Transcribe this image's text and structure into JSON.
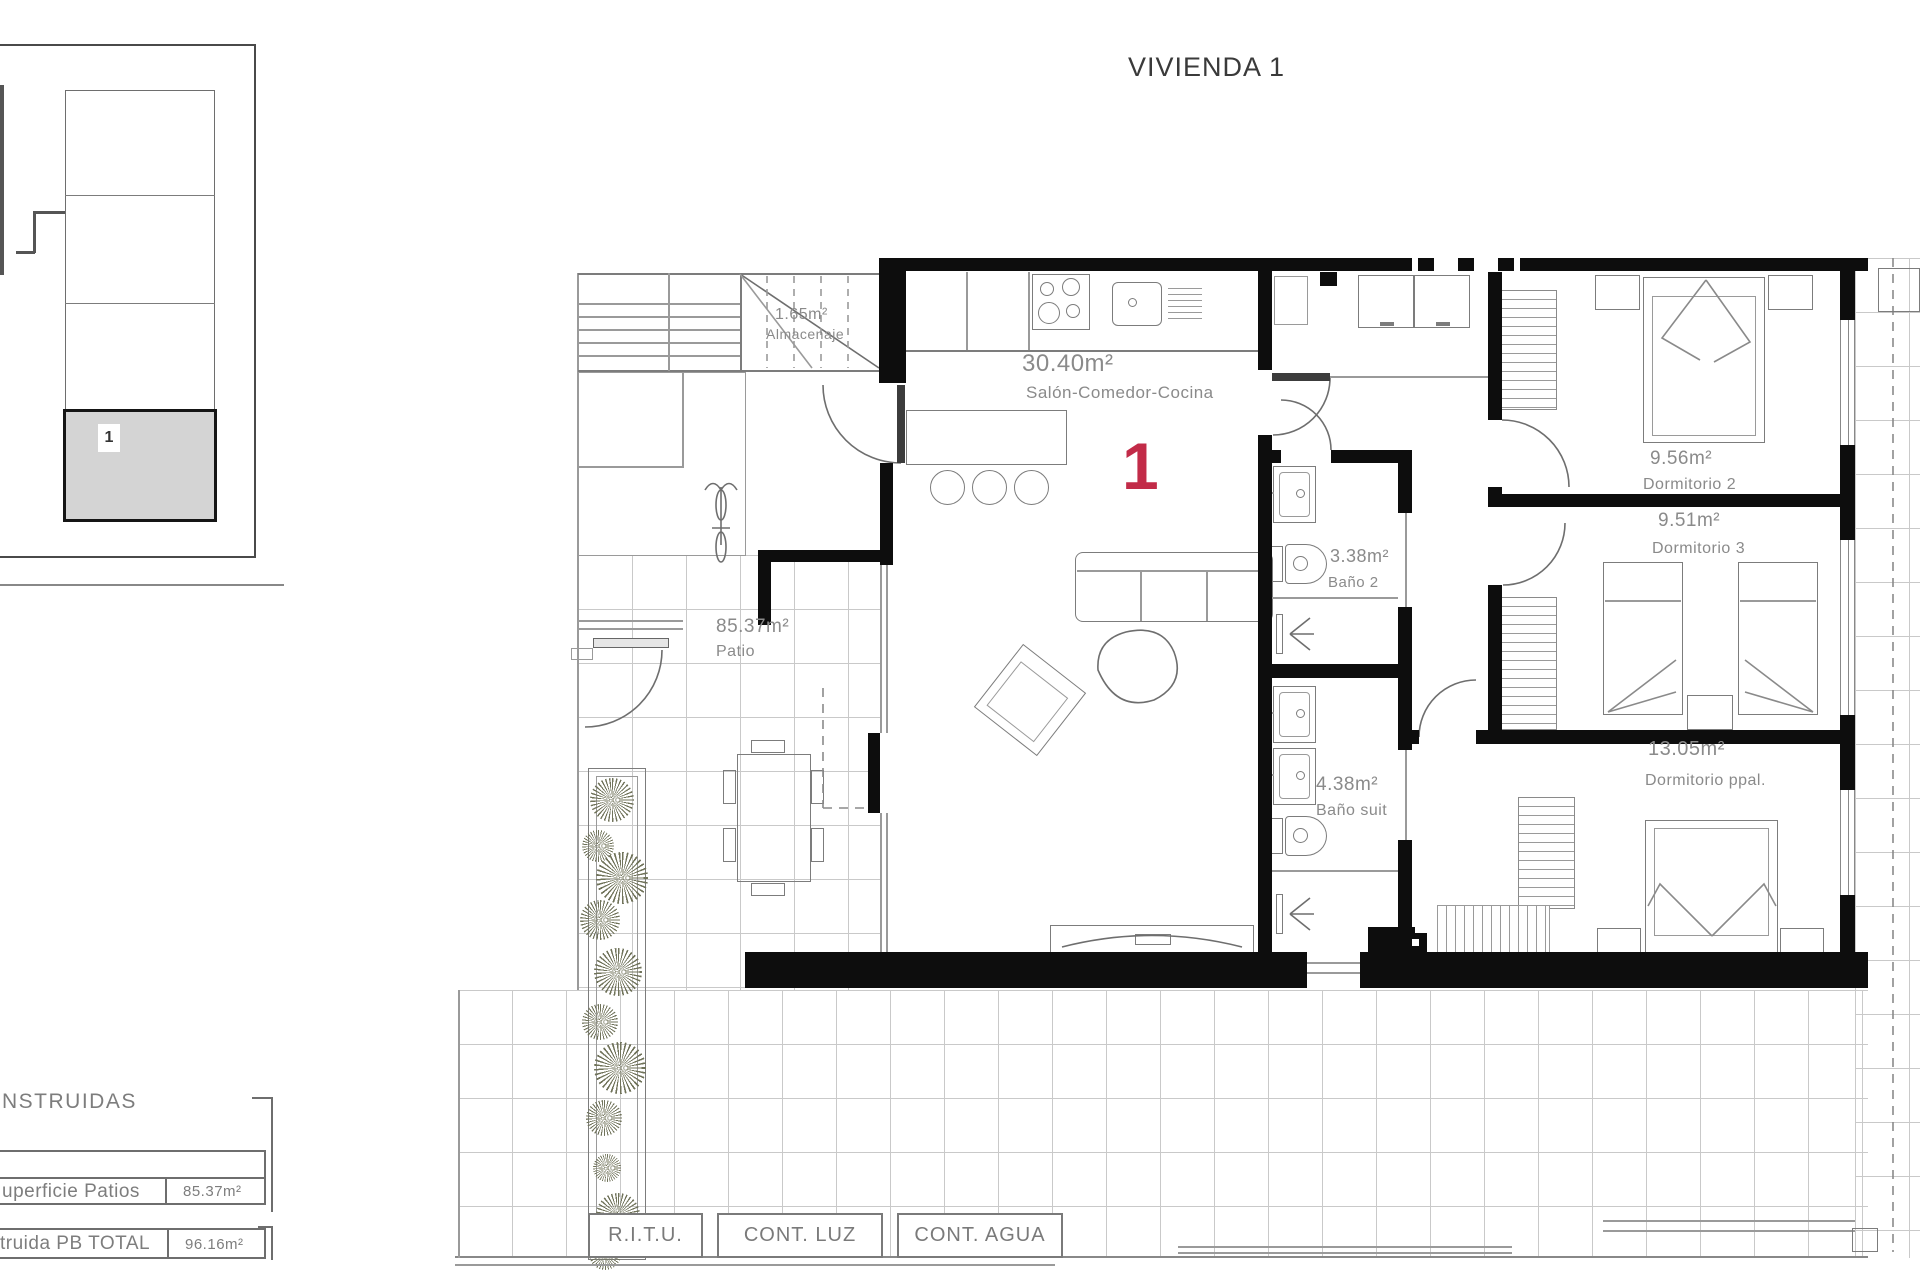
{
  "title": "VIVIENDA 1",
  "unit_number": "1",
  "key_plan": {
    "unit_label": "1"
  },
  "rooms": {
    "almacenaje": {
      "area": "1.65m²",
      "name": "Almacenaje"
    },
    "salon": {
      "area": "30.40m²",
      "name": "Salón-Comedor-Cocina"
    },
    "patio": {
      "area": "85.37m²",
      "name": "Patio"
    },
    "bano2": {
      "area": "3.38m²",
      "name": "Baño 2"
    },
    "bano_suite": {
      "area": "4.38m²",
      "name": "Baño suit"
    },
    "dormitorio_2": {
      "area": "9.56m²",
      "name": "Dormitorio 2"
    },
    "dormitorio_3": {
      "area": "9.51m²",
      "name": "Dormitorio 3"
    },
    "dormitorio_ppal": {
      "area": "13.05m²",
      "name": "Dormitorio ppal."
    }
  },
  "surfaces_table": {
    "header_fragment": "NSTRUIDAS",
    "rows": [
      {
        "label": "uperficie Patios",
        "value": "85.37m²"
      },
      {
        "label": "truida PB TOTAL",
        "value": "96.16m²"
      }
    ]
  },
  "utilities": [
    {
      "label": "R.I.T.U."
    },
    {
      "label": "CONT. LUZ"
    },
    {
      "label": "CONT. AGUA"
    }
  ],
  "colors": {
    "accent_red": "#c22b48",
    "label_gray": "#8a8a8a",
    "wall_black": "#0d0d0d",
    "key_plan_fill": "#d4d4d4"
  }
}
